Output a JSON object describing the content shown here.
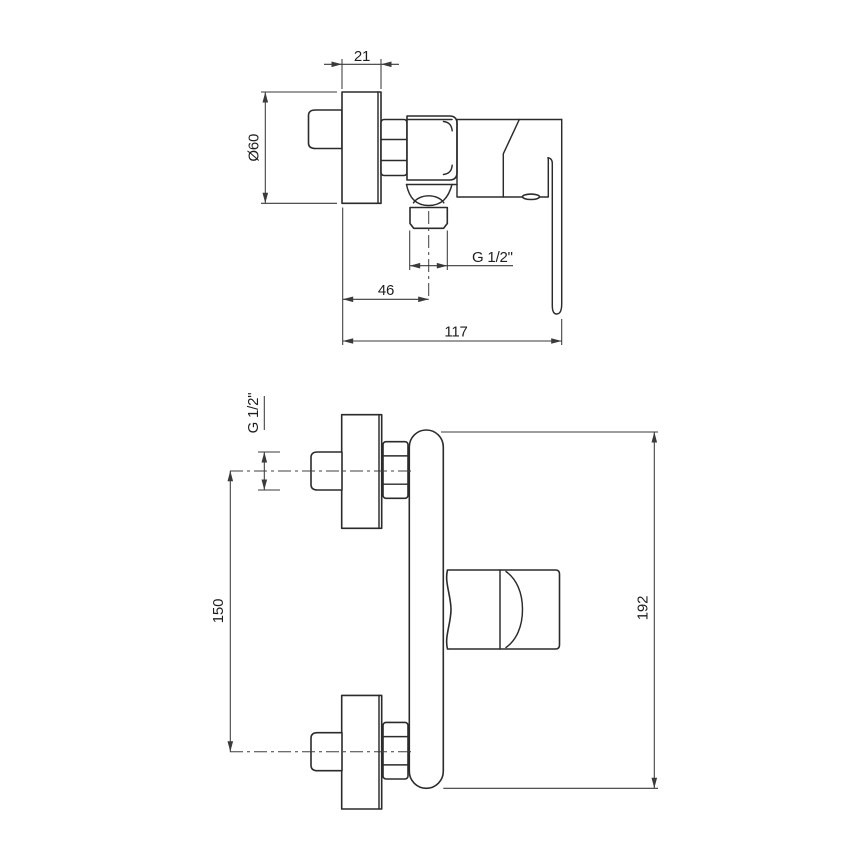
{
  "drawing": {
    "background_color": "#ffffff",
    "outline_color": "#2b2b2b",
    "dimension_color": "#3a3a3a",
    "text_color": "#1e1e1e",
    "side_view": {
      "dims": {
        "escutcheon_depth": "21",
        "escutcheon_diameter": "Ø60",
        "outlet_thread": "G 1/2\"",
        "wall_to_outlet_center": "46",
        "total_depth": "117"
      }
    },
    "front_view": {
      "dims": {
        "inlet_thread": "G 1/2\"",
        "connection_spacing": "150",
        "total_height": "192"
      }
    }
  }
}
